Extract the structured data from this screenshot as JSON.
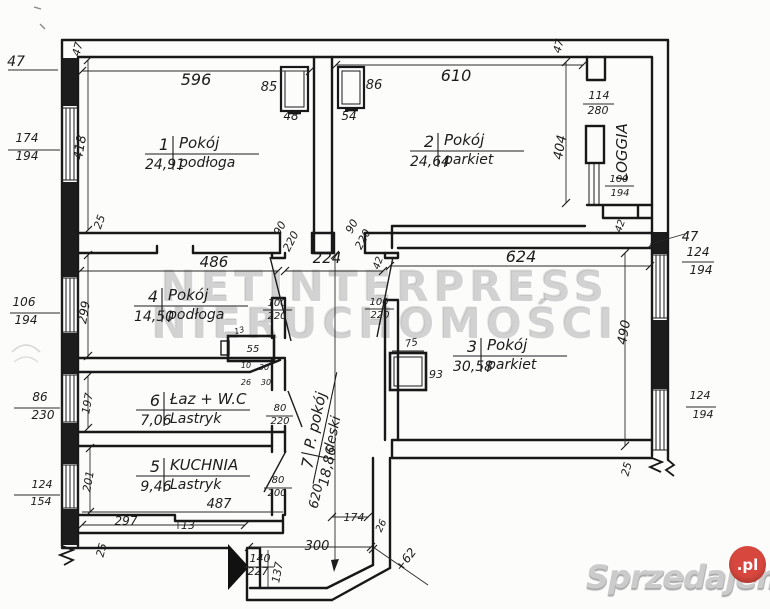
{
  "colors": {
    "ink": "#1c1c1c",
    "dim_ink": "#2a2a2a",
    "paper": "#fcfcfb",
    "watermark_gray": "#9a9a9a",
    "logo_gray": "#cbcbcb",
    "logo_red": "#d7473d"
  },
  "watermark": {
    "line1": "NETINTERPRESS",
    "line2": "NIERUCHOMOŚCI"
  },
  "logo": {
    "text": "Sprzedajemy",
    "tld": ".pl"
  },
  "rooms": [
    {
      "num": "1",
      "name": "Pokój",
      "area": "24,91",
      "floor": "podłoga",
      "x": 197,
      "y": 150,
      "rot": 0
    },
    {
      "num": "2",
      "name": "Pokój",
      "area": "24,64",
      "floor": "parkiet",
      "x": 462,
      "y": 147,
      "rot": 0
    },
    {
      "num": "3",
      "name": "Pokój",
      "area": "30,58",
      "floor": "parkiet",
      "x": 505,
      "y": 352,
      "rot": 0
    },
    {
      "num": "4",
      "name": "Pokój",
      "area": "14,50",
      "floor": "podłoga",
      "x": 186,
      "y": 302,
      "rot": 0
    },
    {
      "num": "6",
      "name": "Łaz + W.C",
      "area": "7,06",
      "floor": "Lastryk",
      "x": 188,
      "y": 406,
      "rot": 0
    },
    {
      "num": "5",
      "name": "KUCHNIA",
      "area": "9,46",
      "floor": "Lastryk",
      "x": 188,
      "y": 472,
      "rot": 0
    },
    {
      "num": "7",
      "name": "P. pokój",
      "area": "18,86",
      "floor": "deski",
      "x": 320,
      "y": 432,
      "rot": -78
    }
  ],
  "dims": [
    {
      "t": "47",
      "x": 16,
      "y": 66,
      "fs": 14
    },
    {
      "t": "47",
      "x": 81,
      "y": 50,
      "rot": -75,
      "fs": 11
    },
    {
      "t": "596",
      "x": 196,
      "y": 85,
      "fs": 16
    },
    {
      "t": "85",
      "x": 269,
      "y": 91,
      "fs": 13
    },
    {
      "t": "48",
      "x": 291,
      "y": 120,
      "fs": 12
    },
    {
      "t": "86",
      "x": 374,
      "y": 89,
      "fs": 13
    },
    {
      "t": "54",
      "x": 349,
      "y": 120,
      "fs": 12
    },
    {
      "t": "610",
      "x": 456,
      "y": 81,
      "fs": 16
    },
    {
      "t": "47",
      "x": 562,
      "y": 47,
      "rot": -75,
      "fs": 11
    },
    {
      "t": "114",
      "x": 599,
      "y": 99,
      "fs": 11
    },
    {
      "t": "280",
      "x": 598,
      "y": 114,
      "fs": 11
    },
    {
      "t": "404",
      "x": 564,
      "y": 148,
      "rot": -80,
      "fs": 13
    },
    {
      "t": "LOGGIA",
      "x": 627,
      "y": 152,
      "rot": -90,
      "fs": 15
    },
    {
      "t": "100",
      "x": 619,
      "y": 182,
      "fs": 10
    },
    {
      "t": "194",
      "x": 620,
      "y": 196,
      "fs": 10
    },
    {
      "t": "174",
      "x": 27,
      "y": 142,
      "fs": 12
    },
    {
      "t": "194",
      "x": 27,
      "y": 160,
      "fs": 12
    },
    {
      "t": "418",
      "x": 84,
      "y": 148,
      "rot": -80,
      "fs": 13
    },
    {
      "t": "25",
      "x": 103,
      "y": 223,
      "rot": -70,
      "fs": 11
    },
    {
      "t": "486",
      "x": 214,
      "y": 267,
      "fs": 15
    },
    {
      "t": "90",
      "x": 283,
      "y": 230,
      "rot": -62,
      "fs": 11
    },
    {
      "t": "220",
      "x": 294,
      "y": 243,
      "rot": -62,
      "fs": 11
    },
    {
      "t": "90",
      "x": 355,
      "y": 228,
      "rot": -62,
      "fs": 11
    },
    {
      "t": "220",
      "x": 366,
      "y": 241,
      "rot": -62,
      "fs": 11
    },
    {
      "t": "224",
      "x": 327,
      "y": 263,
      "fs": 15
    },
    {
      "t": "42",
      "x": 381,
      "y": 264,
      "rot": -70,
      "fs": 10
    },
    {
      "t": "624",
      "x": 521,
      "y": 262,
      "fs": 16
    },
    {
      "t": "106",
      "x": 24,
      "y": 306,
      "fs": 12
    },
    {
      "t": "194",
      "x": 26,
      "y": 324,
      "fs": 12
    },
    {
      "t": "299",
      "x": 88,
      "y": 313,
      "rot": -80,
      "fs": 12
    },
    {
      "t": "100",
      "x": 277,
      "y": 306,
      "fs": 10
    },
    {
      "t": "220",
      "x": 277,
      "y": 319,
      "fs": 10
    },
    {
      "t": "100",
      "x": 379,
      "y": 305,
      "fs": 10
    },
    {
      "t": "220",
      "x": 380,
      "y": 318,
      "fs": 10
    },
    {
      "t": "42",
      "x": 623,
      "y": 227,
      "rot": -70,
      "fs": 10
    },
    {
      "t": "47",
      "x": 690,
      "y": 241,
      "fs": 13
    },
    {
      "t": "124",
      "x": 698,
      "y": 256,
      "fs": 12
    },
    {
      "t": "194",
      "x": 701,
      "y": 274,
      "fs": 12
    },
    {
      "t": "490",
      "x": 628,
      "y": 333,
      "rot": -80,
      "fs": 13
    },
    {
      "t": "13",
      "x": 240,
      "y": 333,
      "rot": -15,
      "fs": 8
    },
    {
      "t": "55",
      "x": 253,
      "y": 352,
      "fs": 10
    },
    {
      "t": "10",
      "x": 246,
      "y": 368,
      "fs": 8
    },
    {
      "t": "30",
      "x": 264,
      "y": 370,
      "fs": 8
    },
    {
      "t": "26",
      "x": 246,
      "y": 385,
      "fs": 8
    },
    {
      "t": "30",
      "x": 266,
      "y": 385,
      "fs": 8
    },
    {
      "t": "75",
      "x": 412,
      "y": 346,
      "rot": -10,
      "fs": 10
    },
    {
      "t": "93",
      "x": 436,
      "y": 378,
      "fs": 11
    },
    {
      "t": "86",
      "x": 40,
      "y": 401,
      "fs": 12
    },
    {
      "t": "230",
      "x": 43,
      "y": 419,
      "fs": 12
    },
    {
      "t": "197",
      "x": 91,
      "y": 404,
      "rot": -80,
      "fs": 11
    },
    {
      "t": "80",
      "x": 280,
      "y": 411,
      "fs": 10
    },
    {
      "t": "220",
      "x": 280,
      "y": 424,
      "fs": 10
    },
    {
      "t": "124",
      "x": 42,
      "y": 488,
      "fs": 11
    },
    {
      "t": "154",
      "x": 41,
      "y": 505,
      "fs": 11
    },
    {
      "t": "201",
      "x": 92,
      "y": 482,
      "rot": -80,
      "fs": 11
    },
    {
      "t": "80",
      "x": 278,
      "y": 483,
      "fs": 10
    },
    {
      "t": "200",
      "x": 277,
      "y": 496,
      "fs": 10
    },
    {
      "t": "487",
      "x": 219,
      "y": 508,
      "fs": 13
    },
    {
      "t": "297",
      "x": 126,
      "y": 525,
      "fs": 12
    },
    {
      "t": "13",
      "x": 188,
      "y": 529,
      "fs": 11
    },
    {
      "t": "25",
      "x": 105,
      "y": 551,
      "rot": -75,
      "fs": 11
    },
    {
      "t": "140",
      "x": 260,
      "y": 562,
      "fs": 11
    },
    {
      "t": "227",
      "x": 258,
      "y": 575,
      "fs": 11
    },
    {
      "t": "137",
      "x": 281,
      "y": 573,
      "rot": -80,
      "fs": 11
    },
    {
      "t": "300",
      "x": 317,
      "y": 550,
      "fs": 13
    },
    {
      "t": "174",
      "x": 354,
      "y": 521,
      "fs": 11
    },
    {
      "t": "26",
      "x": 384,
      "y": 527,
      "rot": -65,
      "fs": 10
    },
    {
      "t": "+62",
      "x": 409,
      "y": 562,
      "rot": -52,
      "fs": 12
    },
    {
      "t": "25",
      "x": 630,
      "y": 470,
      "rot": -75,
      "fs": 11
    },
    {
      "t": "124",
      "x": 700,
      "y": 399,
      "fs": 11
    },
    {
      "t": "194",
      "x": 703,
      "y": 418,
      "fs": 11
    },
    {
      "t": "620",
      "x": 320,
      "y": 497,
      "rot": -78,
      "fs": 13
    }
  ]
}
